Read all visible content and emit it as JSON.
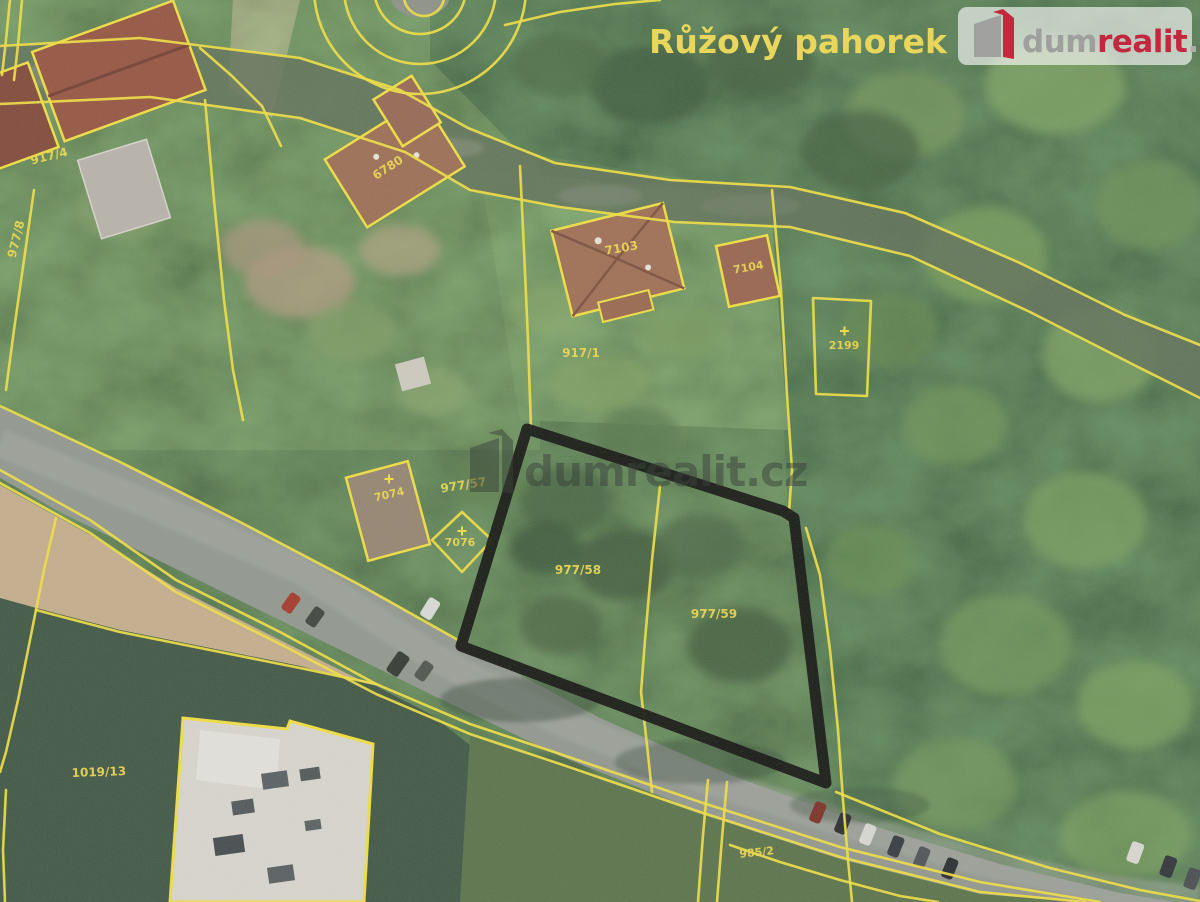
{
  "header": {
    "area_label": "Růžový pahorek"
  },
  "branding": {
    "logo": {
      "part1": "dum",
      "part2": "realit",
      "part3": ".cz"
    },
    "watermark": {
      "part1": "dum",
      "part2": "realit",
      "part3": ".cz"
    }
  },
  "parcel_labels": {
    "l917_4": "917/4",
    "l977_8": "977/8",
    "l6780": "6780",
    "l7103": "7103",
    "l7104": "7104",
    "l917_1": "917/1",
    "l2199": "2199",
    "l977_57": "977/57",
    "l7074": "7074",
    "l7076": "7076",
    "l977_58": "977/58",
    "l977_59": "977/59",
    "l1019_13": "1019/13",
    "l985_2": "985/2"
  },
  "colors": {
    "cadastral_line": "#f2df3d",
    "highlight_outline": "#0c0c0a",
    "brand_red": "#c5122e",
    "label_yellow": "#ecd74a"
  }
}
